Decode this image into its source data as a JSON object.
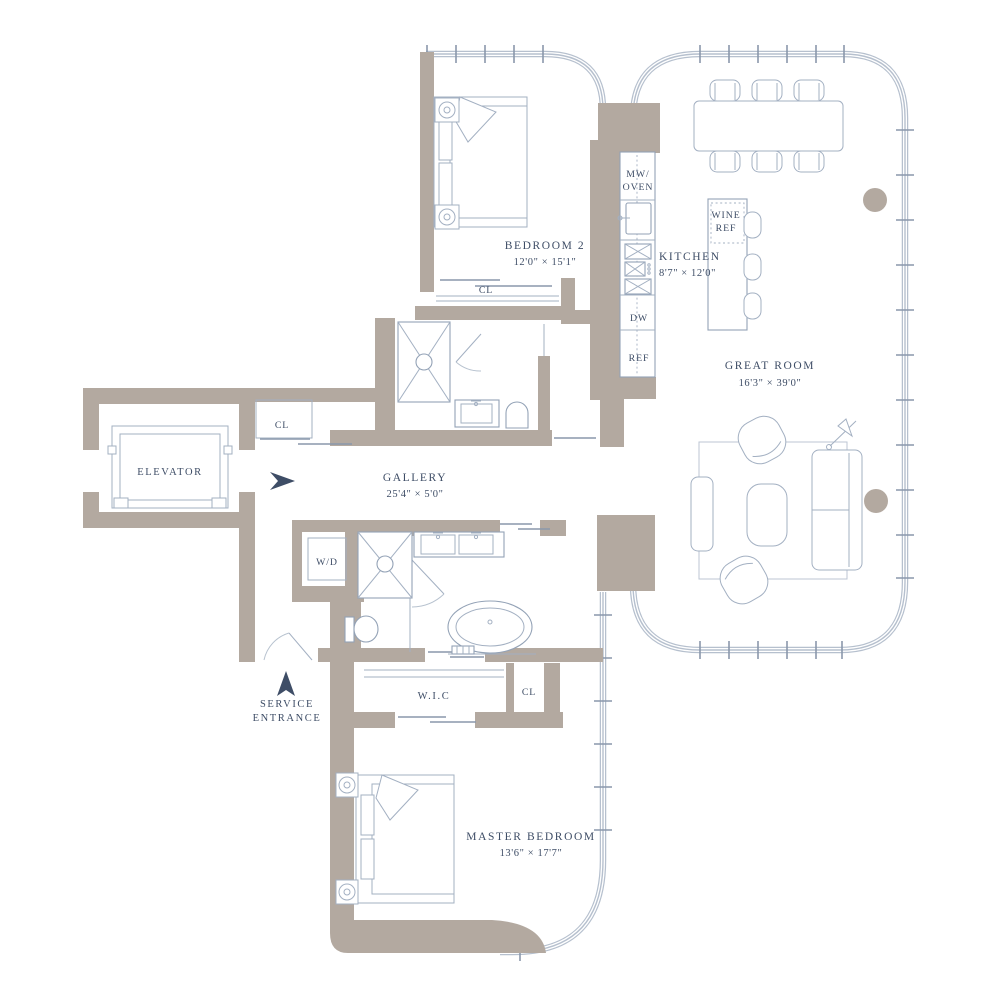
{
  "plan_title": "Residence Floor Plan",
  "colors": {
    "wall": "#b3a9a0",
    "glass": "#b6c0ce",
    "fixture_line": "#a3b0c2",
    "text": "#3e4d66"
  },
  "rooms": {
    "bedroom2": {
      "name": "BEDROOM 2",
      "dims": "12'0\" × 15'1\""
    },
    "kitchen": {
      "name": "KITCHEN",
      "dims": "8'7\" × 12'0\""
    },
    "great_room": {
      "name": "GREAT ROOM",
      "dims": "16'3\" × 39'0\""
    },
    "gallery": {
      "name": "GALLERY",
      "dims": "25'4\" × 5'0\""
    },
    "master_bedroom": {
      "name": "MASTER BEDROOM",
      "dims": "13'6\" × 17'7\""
    },
    "elevator": {
      "name": "ELEVATOR"
    },
    "wic": {
      "name": "W.I.C"
    },
    "service_entrance": {
      "line1": "SERVICE",
      "line2": "ENTRANCE"
    }
  },
  "closets": {
    "bedroom2_closet": "CL",
    "gallery_closet": "CL",
    "master_closet": "CL"
  },
  "appliances": {
    "microwave_oven": {
      "line1": "MW/",
      "line2": "OVEN"
    },
    "dishwasher": "DW",
    "refrigerator": "REF",
    "wine_ref": {
      "line1": "WINE",
      "line2": "REF"
    },
    "washer_dryer": "W/D"
  },
  "icons": {
    "gallery_entry_arrow": "right-arrow",
    "service_entrance_arrow": "up-arrow"
  }
}
